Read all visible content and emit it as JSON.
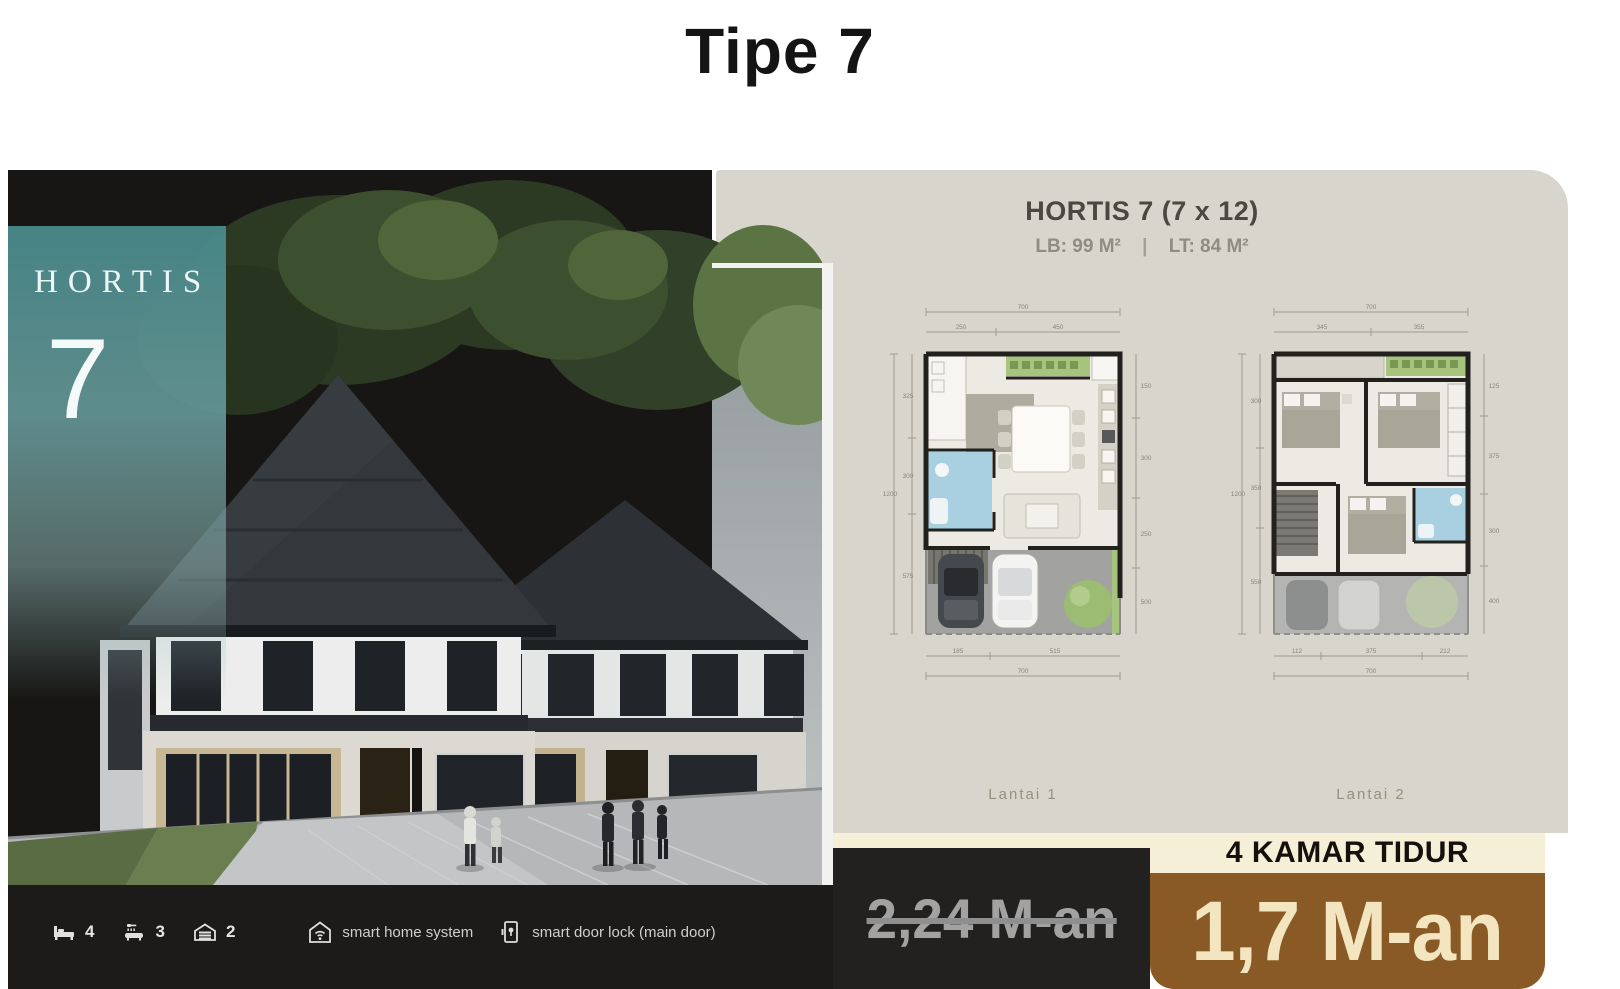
{
  "page": {
    "title": "Tipe 7"
  },
  "hero": {
    "brand": "HORTIS",
    "unit_number": "7",
    "amenities": [
      {
        "icon": "bed-icon",
        "count": "4"
      },
      {
        "icon": "shower-icon",
        "count": "3"
      },
      {
        "icon": "garage-icon",
        "count": "2"
      }
    ],
    "features": [
      {
        "icon": "smart-home-icon",
        "label": "smart home system"
      },
      {
        "icon": "smart-door-lock-icon",
        "label": "smart door lock (main door)"
      }
    ]
  },
  "floorplan_panel": {
    "title": "HORTIS 7 (7 x 12)",
    "building_area_label": "LB: 99 M²",
    "separator": "|",
    "land_area_label": "LT: 84 M²",
    "plans": [
      {
        "label": "Lantai 1",
        "dims": {
          "top_total": "700",
          "top_seg1": "250",
          "top_seg2": "450",
          "left_total": "1200",
          "left_seg1": "325",
          "left_seg2": "300",
          "left_seg3": "575",
          "right_seg1": "150",
          "right_seg2": "300",
          "right_seg3": "250",
          "right_seg4": "500",
          "bottom_seg1": "185",
          "bottom_seg2": "515",
          "bottom_total": "700"
        }
      },
      {
        "label": "Lantai 2",
        "dims": {
          "top_total": "700",
          "top_seg1": "345",
          "top_seg2": "355",
          "left_total": "1200",
          "left_seg1": "300",
          "left_seg2": "350",
          "left_seg3": "550",
          "right_seg1": "125",
          "right_seg2": "375",
          "right_seg3": "300",
          "right_seg4": "400",
          "bottom_seg1": "112",
          "bottom_seg2": "375",
          "bottom_seg3": "212",
          "bottom_total": "700"
        }
      }
    ]
  },
  "pricing": {
    "bedrooms_banner": "4 KAMAR TIDUR",
    "old_price": "2,24 M-an",
    "new_price": "1,7 M-an"
  },
  "colors": {
    "teal_accent": "#4f8f90",
    "panel_beige": "#d8d5cc",
    "price_brown": "#8a5a26",
    "banner_cream": "#f6efd8",
    "card_dark": "#1c1b19",
    "old_price_gray": "#a2a2a2",
    "new_price_cream": "#f3e5bf"
  }
}
